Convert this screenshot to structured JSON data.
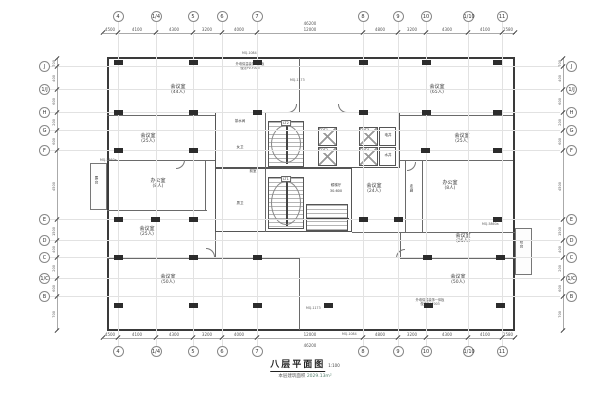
{
  "title_block": {
    "title": "八层平面图",
    "scale": "1:100",
    "area_label": "本层建筑面积",
    "area_value": "2029.13m²"
  },
  "grid": {
    "cols": [
      "4",
      "1/4",
      "5",
      "6",
      "7",
      "8",
      "9",
      "10",
      "1/10",
      "11"
    ],
    "rows": [
      "J",
      "1/J",
      "H",
      "G",
      "F",
      "E",
      "D",
      "C",
      "1/C",
      "B"
    ]
  },
  "dims": {
    "top": [
      "4500",
      "4100",
      "4300",
      "3200",
      "4000",
      "12000",
      "4800",
      "3200",
      "4300",
      "4100",
      "1580"
    ],
    "top_total": "46200",
    "bottom": [
      "4500",
      "4100",
      "4300",
      "3200",
      "4000",
      "12000",
      "4800",
      "3200",
      "4300",
      "4100",
      "1580"
    ],
    "bottom_total": "46200",
    "left": [
      "700",
      "400",
      "600",
      "200",
      "600",
      "4500",
      "1500",
      "400",
      "200",
      "600",
      "700"
    ],
    "right": [
      "700",
      "400",
      "600",
      "200",
      "600",
      "4500",
      "1500",
      "400",
      "200",
      "600",
      "700"
    ]
  },
  "rooms": [
    {
      "name": "会议室",
      "cap": "(44人)"
    },
    {
      "name": "会议室",
      "cap": "(65人)"
    },
    {
      "name": "会议室",
      "cap": "(25人)"
    },
    {
      "name": "会议室",
      "cap": "(25人)"
    },
    {
      "name": "办公室",
      "cap": "(8人)"
    },
    {
      "name": "办公室",
      "cap": "(8人)"
    },
    {
      "name": "会议室",
      "cap": "(24人)"
    },
    {
      "name": "会议室",
      "cap": "(25人)"
    },
    {
      "name": "会议室",
      "cap": "(25人)"
    },
    {
      "name": "会议室",
      "cap": "(50人)"
    },
    {
      "name": "会议室",
      "cap": "(50人)"
    }
  ],
  "core": {
    "stair_1": "LT1",
    "stair_2": "LT2",
    "elevators": [
      "DT1",
      "DT2",
      "DT3",
      "DT4"
    ],
    "shafts": [
      "电井",
      "水井"
    ],
    "lobby": "候梯厅",
    "elevation": "30.600",
    "wc_female": "女卫",
    "wc_male": "男卫",
    "anteroom": "前室",
    "tea_room": "茶水间",
    "corridor": "走廊",
    "balcony_left": "露台",
    "balcony_right": "阳台"
  },
  "tags": {
    "curtain_wall_top": "MQ-1084",
    "curtain_wall_bottom": "MQ-1084",
    "curtain_wall_mid_upper": "MQ-1173",
    "curtain_wall_mid_lower": "MQ-1173",
    "curtain_wall_left": "MQ-5860a",
    "curtain_wall_right": "MQ-5860a",
    "note_line1": "外墙保温装饰一体板",
    "note_line2": "做法PV-F003"
  },
  "colors": {
    "wall": "#3a3a3a",
    "grid_line": "#e2e2e2",
    "area_accent": "#55806e"
  }
}
